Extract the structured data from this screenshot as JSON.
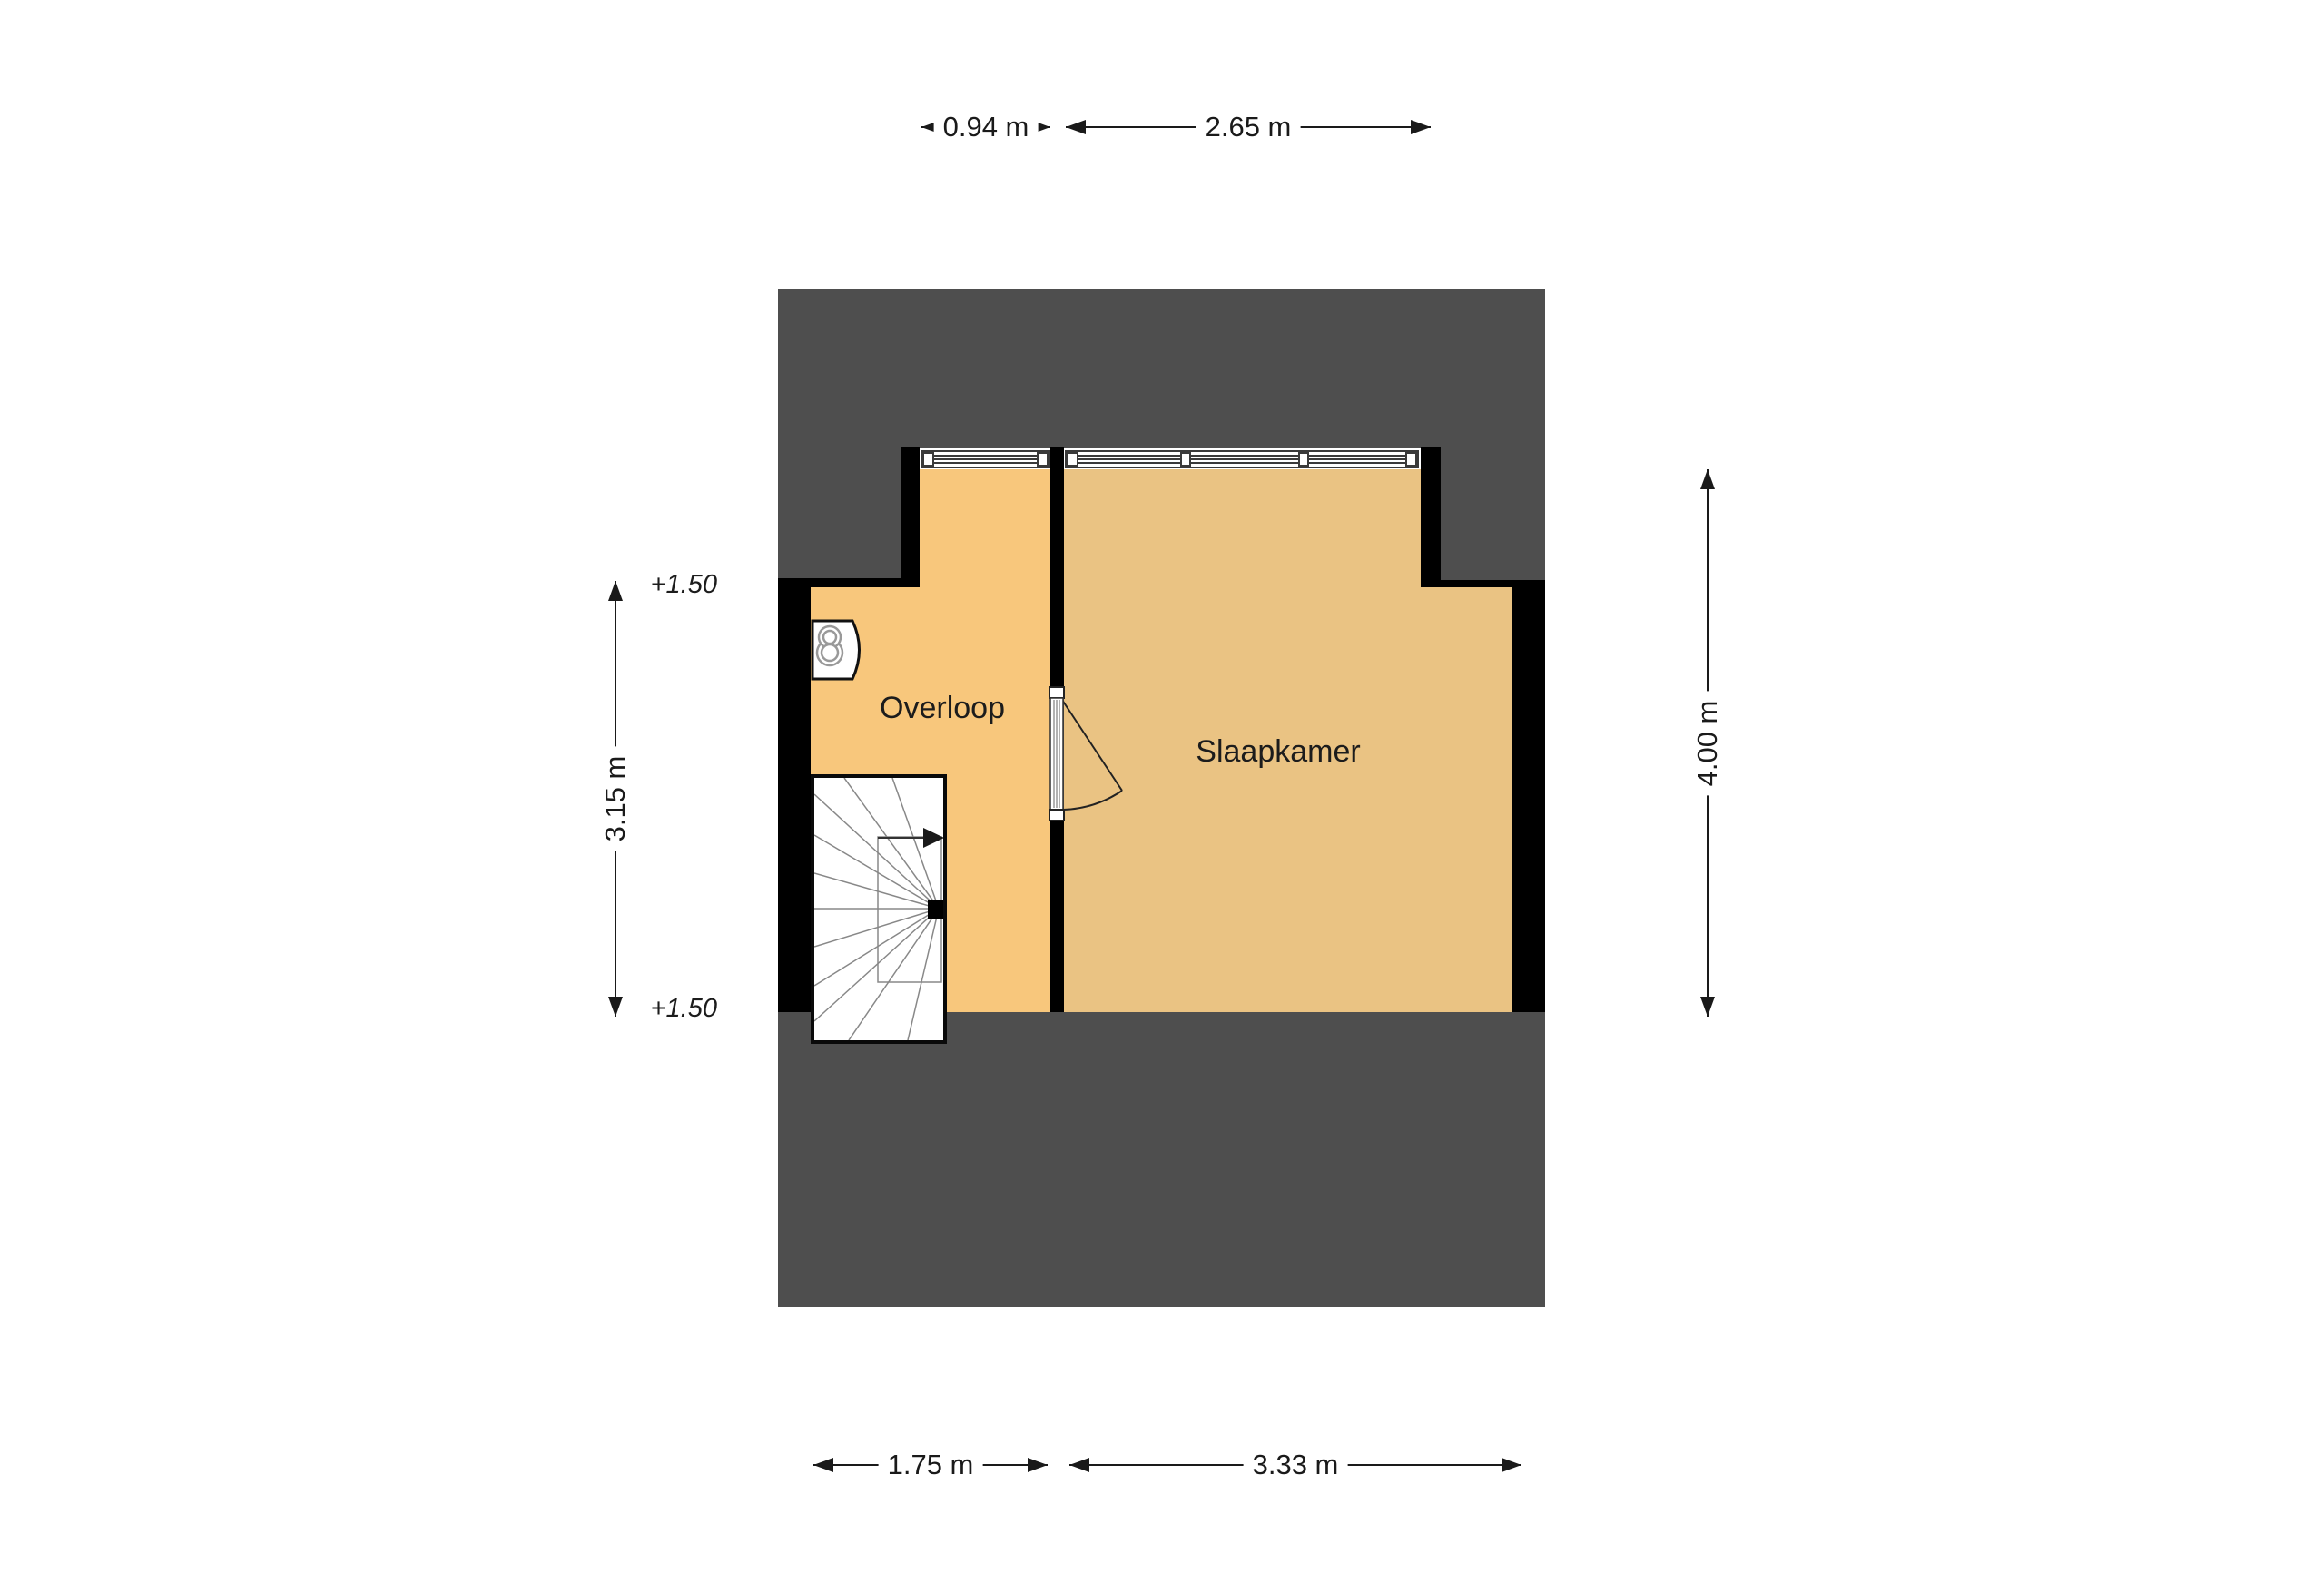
{
  "floorplan": {
    "rooms": {
      "overloop": {
        "label": "Overloop"
      },
      "slaapkamer": {
        "label": "Slaapkamer"
      }
    },
    "level_markers": {
      "upper": {
        "label": "+1.50"
      },
      "lower": {
        "label": "+1.50"
      }
    },
    "dimensions": {
      "top_overloop": {
        "label": "0.94 m"
      },
      "top_slaapkamer": {
        "label": "2.65 m"
      },
      "left_overloop": {
        "label": "3.15 m"
      },
      "right_slaapkamer": {
        "label": "4.00 m"
      },
      "bottom_overloop": {
        "label": "1.75 m"
      },
      "bottom_slaapkamer": {
        "label": "3.33 m"
      }
    },
    "colors": {
      "page": "#FFFFFF",
      "backdrop": "#4E4E4E",
      "overloop_floor": "#F8C77C",
      "slaapkamer_floor": "#EAC383",
      "walls": "#000000",
      "dimension_ink": "#1A1A1A"
    }
  }
}
